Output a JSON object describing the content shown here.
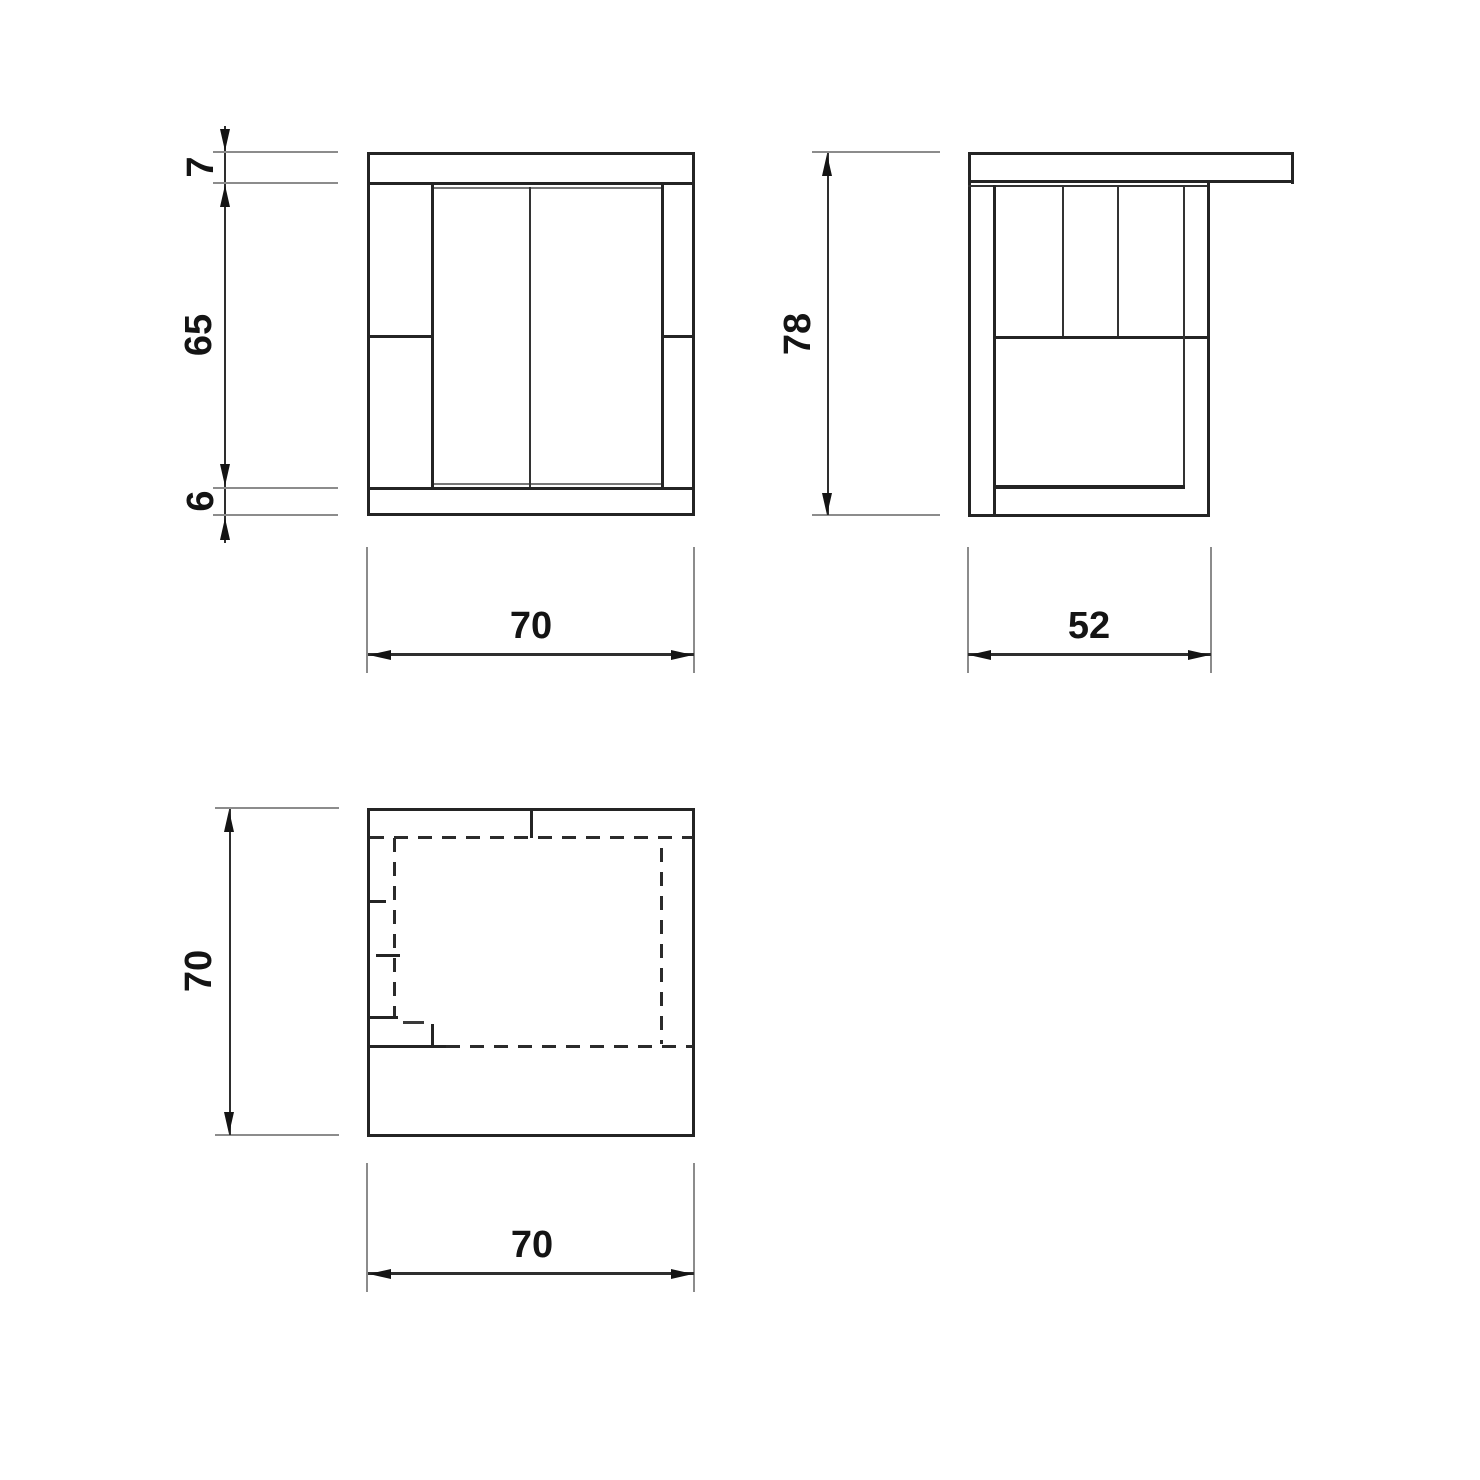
{
  "labels": {
    "front_top_thickness": "7",
    "front_body_height": "65",
    "front_base_height": "6",
    "front_width": "70",
    "side_height": "78",
    "side_depth": "52",
    "plan_depth": "70",
    "plan_width": "70"
  },
  "colors": {
    "line_primary": "#242424",
    "line_secondary": "#8c8c8c",
    "background": "#ffffff"
  }
}
